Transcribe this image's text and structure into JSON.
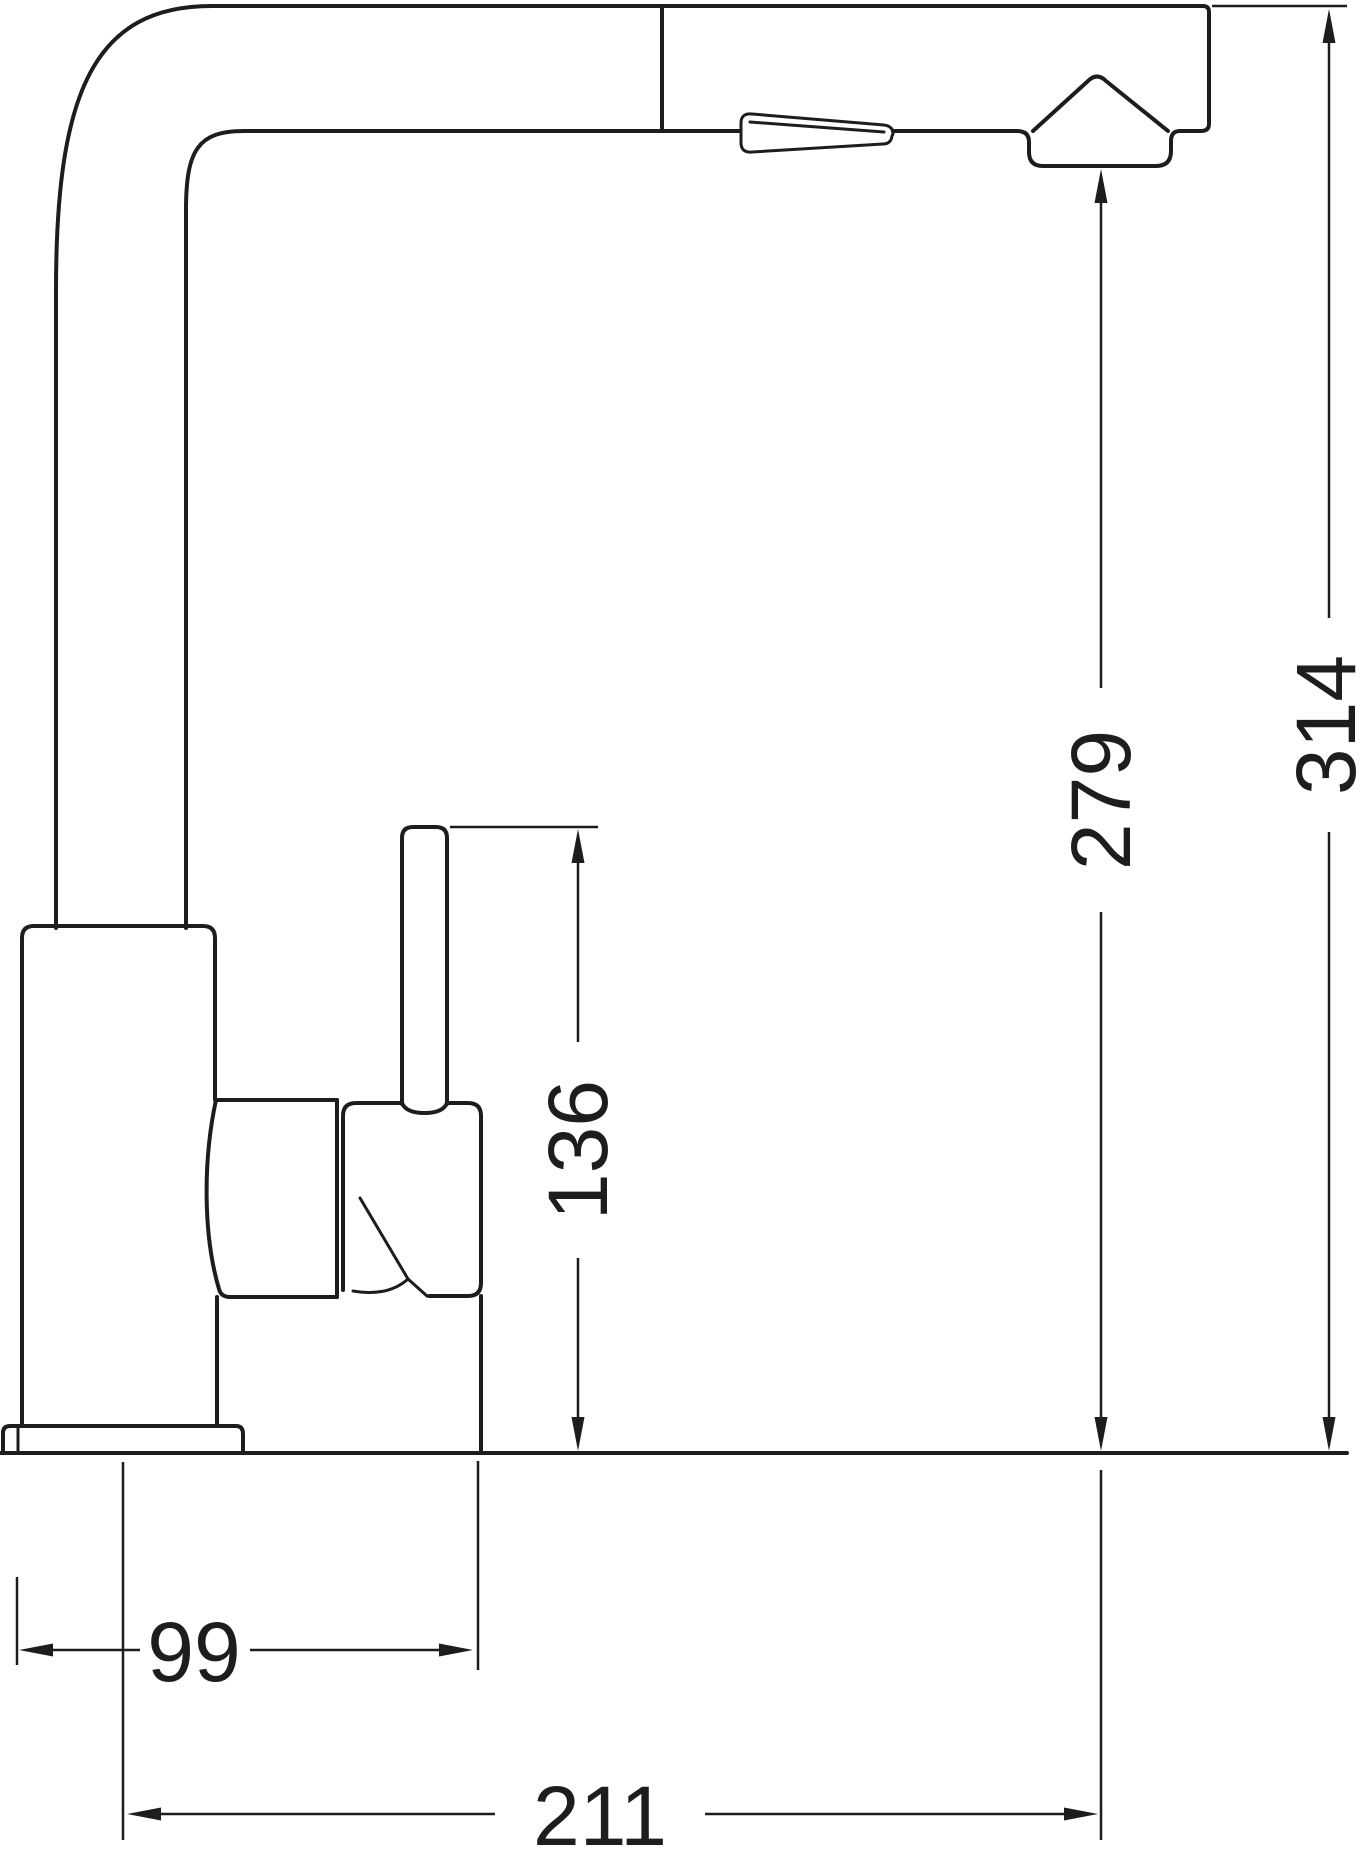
{
  "drawing": {
    "kind": "faucet-dimension-drawing",
    "colors": {
      "line": "#1d1d1b",
      "background": "#ffffff"
    },
    "dimensions": {
      "handle_height": "136",
      "outlet_height": "279",
      "total_height": "314",
      "base_offset": "99",
      "spout_reach": "211"
    }
  }
}
